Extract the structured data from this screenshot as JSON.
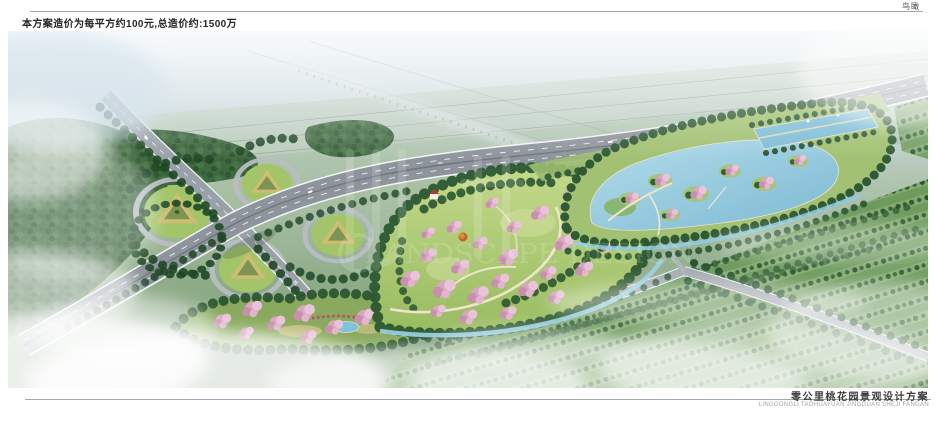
{
  "sheet": {
    "view_label": "鸟瞰",
    "cost_note": "本方案造价为每平方约100元,总造价约:1500万",
    "title_cn": "零公里桃花园景观设计方案",
    "title_pinyin": "LINGGONGLI TAOHUAYUAN JINGGUAN SHEJI FANGAN"
  },
  "watermark": {
    "text": "LANDSCAPE DESIGN"
  },
  "scene_palette": {
    "haze_sky": "#e7eff2",
    "field_green": "#a4bba1",
    "forest_green": "#2c5530",
    "lawn_green": "#a3c468",
    "blossom_pink": "#d9a6c2",
    "water_blue": "#84c0d8",
    "road_grey": "#99a1a8",
    "infield_tan": "#cdbd72"
  }
}
